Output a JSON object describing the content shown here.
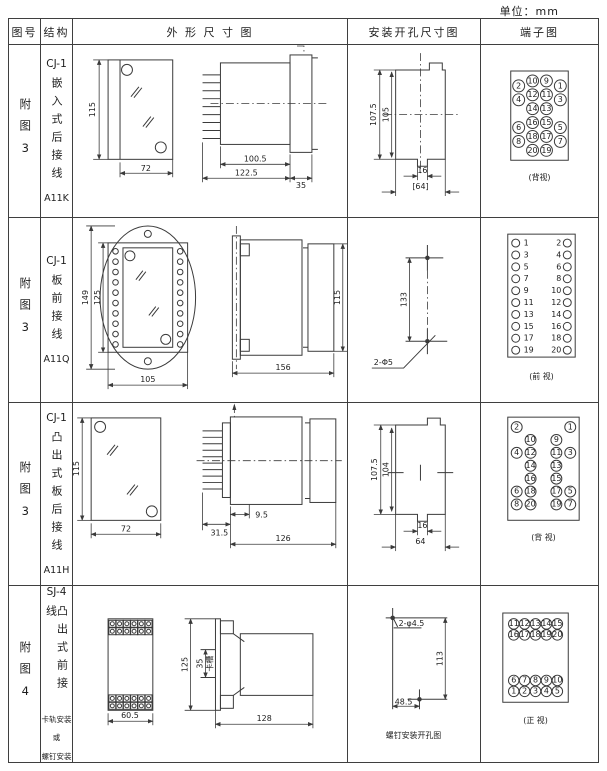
{
  "unit_label": "单位：mm",
  "headers": {
    "figure": "图号",
    "structure": "结构",
    "outline": "外 形 尺 寸 图",
    "install": "安装开孔尺寸图",
    "terminal": "端子图"
  },
  "rows": [
    {
      "figure_no": "附图3",
      "model": "CJ-1",
      "mounting": "嵌入式后接线",
      "code": "A11K",
      "outline": {
        "h": "115",
        "w": "72",
        "body": "100.5",
        "total": "122.5",
        "flange": "35"
      },
      "install": {
        "outer_h": "107.5",
        "inner_h": "105",
        "slot_w": "16",
        "width": "[64]"
      },
      "terminal": {
        "caption": "(背视)",
        "inner_pairs": [
          [
            "10",
            "9"
          ],
          [
            "12",
            "11"
          ],
          [
            "14",
            "13"
          ],
          [
            "16",
            "15"
          ],
          [
            "18",
            "17"
          ],
          [
            "20",
            "19"
          ]
        ],
        "outer_pairs": [
          [
            "2",
            "1"
          ],
          [
            "4",
            "3"
          ],
          [
            "6",
            "5"
          ],
          [
            "8",
            "7"
          ]
        ]
      }
    },
    {
      "figure_no": "附图3",
      "model": "CJ-1",
      "mounting": "板前接线",
      "code": "A11Q",
      "outline": {
        "h1": "149",
        "h2": "125",
        "w": "105",
        "depth": "156",
        "h3": "115"
      },
      "install": {
        "h": "133",
        "holes": "2-Φ5"
      },
      "terminal": {
        "caption": "(前 视)",
        "left": [
          "1",
          "3",
          "5",
          "7",
          "9",
          "11",
          "13",
          "15",
          "17",
          "19"
        ],
        "right": [
          "2",
          "4",
          "6",
          "8",
          "10",
          "12",
          "14",
          "16",
          "18",
          "20"
        ]
      }
    },
    {
      "figure_no": "附图3",
      "model": "CJ-1",
      "mounting": "凸出式板后接线",
      "code": "A11H",
      "outline": {
        "h": "115",
        "w": "72",
        "pin": "31.5",
        "panel": "9.5",
        "depth": "126"
      },
      "install": {
        "outer_h": "107.5",
        "inner_h": "104",
        "slot_w": "16",
        "width": "64"
      },
      "terminal": {
        "caption": "(背 视)",
        "rows": [
          {
            "outer": [
              "2",
              "1"
            ]
          },
          {
            "inner": [
              "10",
              "9"
            ]
          },
          {
            "outer": [
              "4",
              "3"
            ],
            "inner": [
              "12",
              "11"
            ]
          },
          {
            "inner": [
              "14",
              "13"
            ]
          },
          {
            "inner": [
              "16",
              "15"
            ]
          },
          {
            "outer": [
              "6",
              "5"
            ],
            "inner": [
              "18",
              "17"
            ]
          },
          {
            "outer": [
              "8",
              "7"
            ],
            "inner": [
              "20",
              "19"
            ]
          }
        ]
      }
    },
    {
      "figure_no": "附图4",
      "model": "SJ-4",
      "mounting": "凸出式前接线",
      "note_lines": [
        "卡轨安装",
        "或",
        "螺钉安装"
      ],
      "outline": {
        "h": "125",
        "slot": "35",
        "slot_label": "卡槽",
        "depth": "128",
        "w": "60.5"
      },
      "install": {
        "h": "113",
        "w": "48.5",
        "holes": "2-φ4.5",
        "caption": "螺钉安装开孔图"
      },
      "terminal": {
        "caption": "(正 视)",
        "top_rows": [
          [
            "11",
            "12",
            "13",
            "14",
            "15"
          ],
          [
            "16",
            "17",
            "18",
            "19",
            "20"
          ]
        ],
        "bottom_rows": [
          [
            "6",
            "7",
            "8",
            "9",
            "10"
          ],
          [
            "1",
            "2",
            "3",
            "4",
            "5"
          ]
        ]
      }
    }
  ]
}
